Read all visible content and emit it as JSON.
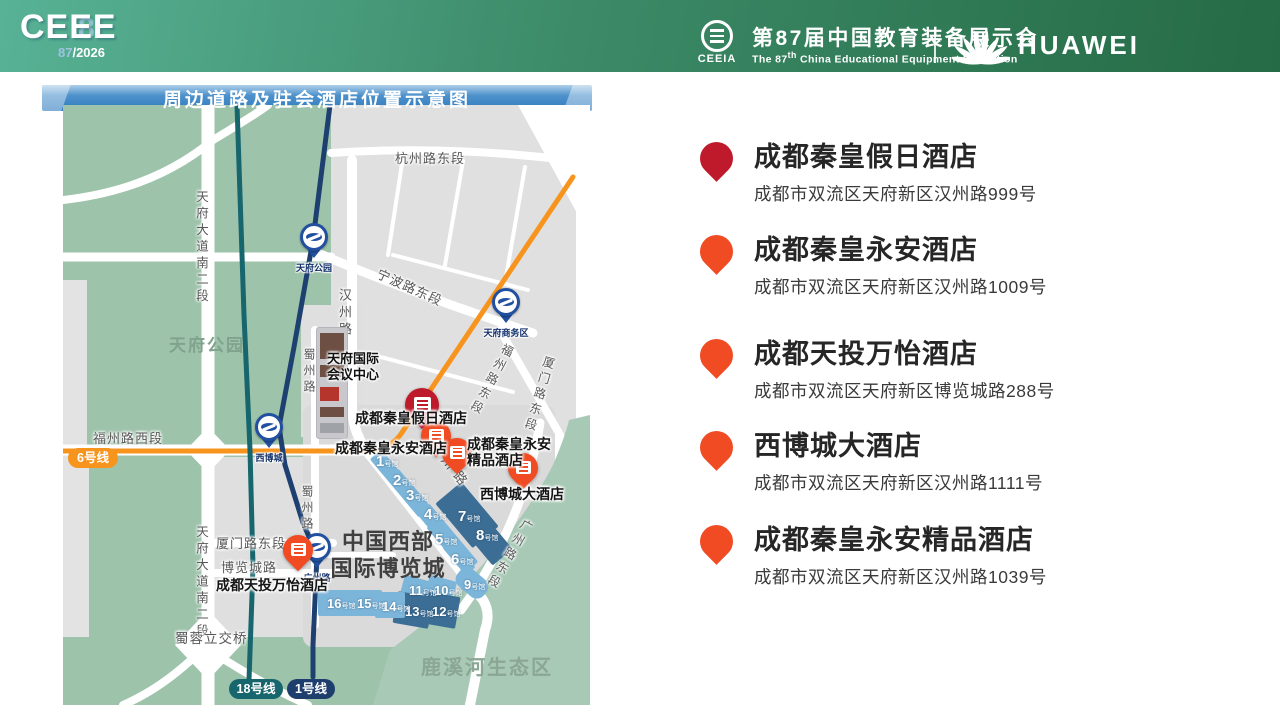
{
  "header": {
    "logo": {
      "brand": "CEEE",
      "number": "87",
      "year": "/2026",
      "eight": "8"
    },
    "ceeia": {
      "abbr": "CEEIA"
    },
    "title_cn": "第87届中国教育装备展示会",
    "title_en_pre": "The 87",
    "title_en_sup": "th",
    "title_en_post": " China Educational Equipment Exhibition",
    "huawei": "HUAWEI"
  },
  "banner": {
    "title": "周边道路及驻会酒店位置示意图"
  },
  "map": {
    "road_labels": [
      "杭州路东段",
      "天府大道南二段",
      "宁波路东段",
      "汉州路",
      "蜀州路",
      "福州路西段",
      "福州路东段",
      "厦门路东段",
      "天府大道南二段",
      "厦门路东段",
      "博览城路",
      "蜀州路",
      "蜀蓉立交桥",
      "广州路东段",
      "汉州路"
    ],
    "area_labels": {
      "park": "天府公园",
      "eco": "鹿溪河生态区"
    },
    "venue": {
      "line1": "中国西部",
      "line2": "国际博览城"
    },
    "conference": {
      "line1": "天府国际",
      "line2": "会议中心"
    },
    "halls": [
      "1",
      "2",
      "3",
      "4",
      "5",
      "6",
      "7",
      "8",
      "9",
      "10",
      "11",
      "12",
      "13",
      "14",
      "15",
      "16"
    ],
    "hall_suffix": "号馆",
    "metro": {
      "badges": [
        {
          "label": "6号线",
          "color": "#F7941D"
        },
        {
          "label": "18号线",
          "color": "#17666E"
        },
        {
          "label": "1号线",
          "color": "#1E3F6E"
        }
      ],
      "stations": [
        "天府公园",
        "天府商务区",
        "西博城",
        "广州路"
      ]
    },
    "hotel_labels": {
      "jiari": "成都秦皇假日酒店",
      "yongan": "成都秦皇永安酒店",
      "jingpin1": "成都秦皇永安",
      "jingpin2": "精品酒店",
      "xibocheng": "西博城大酒店",
      "wanyi": "成都天投万怡酒店"
    }
  },
  "hotels": [
    {
      "name": "成都秦皇假日酒店",
      "address": "成都市双流区天府新区汉州路999号",
      "pin_color": "#BE1A2B"
    },
    {
      "name": "成都秦皇永安酒店",
      "address": "成都市双流区天府新区汉州路1009号",
      "pin_color": "#F04B23"
    },
    {
      "name": "成都天投万怡酒店",
      "address": "成都市双流区天府新区博览城路288号",
      "pin_color": "#F04B23"
    },
    {
      "name": "西博城大酒店",
      "address": "成都市双流区天府新区汉州路1111号",
      "pin_color": "#F04B23"
    },
    {
      "name": "成都秦皇永安精品酒店",
      "address": "成都市双流区天府新区汉州路1039号",
      "pin_color": "#F04B23"
    }
  ],
  "colors": {
    "header_green_left": "#58B295",
    "header_green_right": "#256B45",
    "banner_blue": "#2E7ABD",
    "park_green": "#9EC3AB",
    "eco_green": "#A7C9B5",
    "block_grey": "#E0E0E0",
    "line6_orange": "#F7941D",
    "line18_teal": "#17666E",
    "line1_navy": "#1E4070",
    "hall_light_blue": "#7CB5DA",
    "hall_dark_blue": "#3C6E95",
    "pin_dark_red": "#BE1A2B",
    "pin_orange": "#F04B23"
  }
}
